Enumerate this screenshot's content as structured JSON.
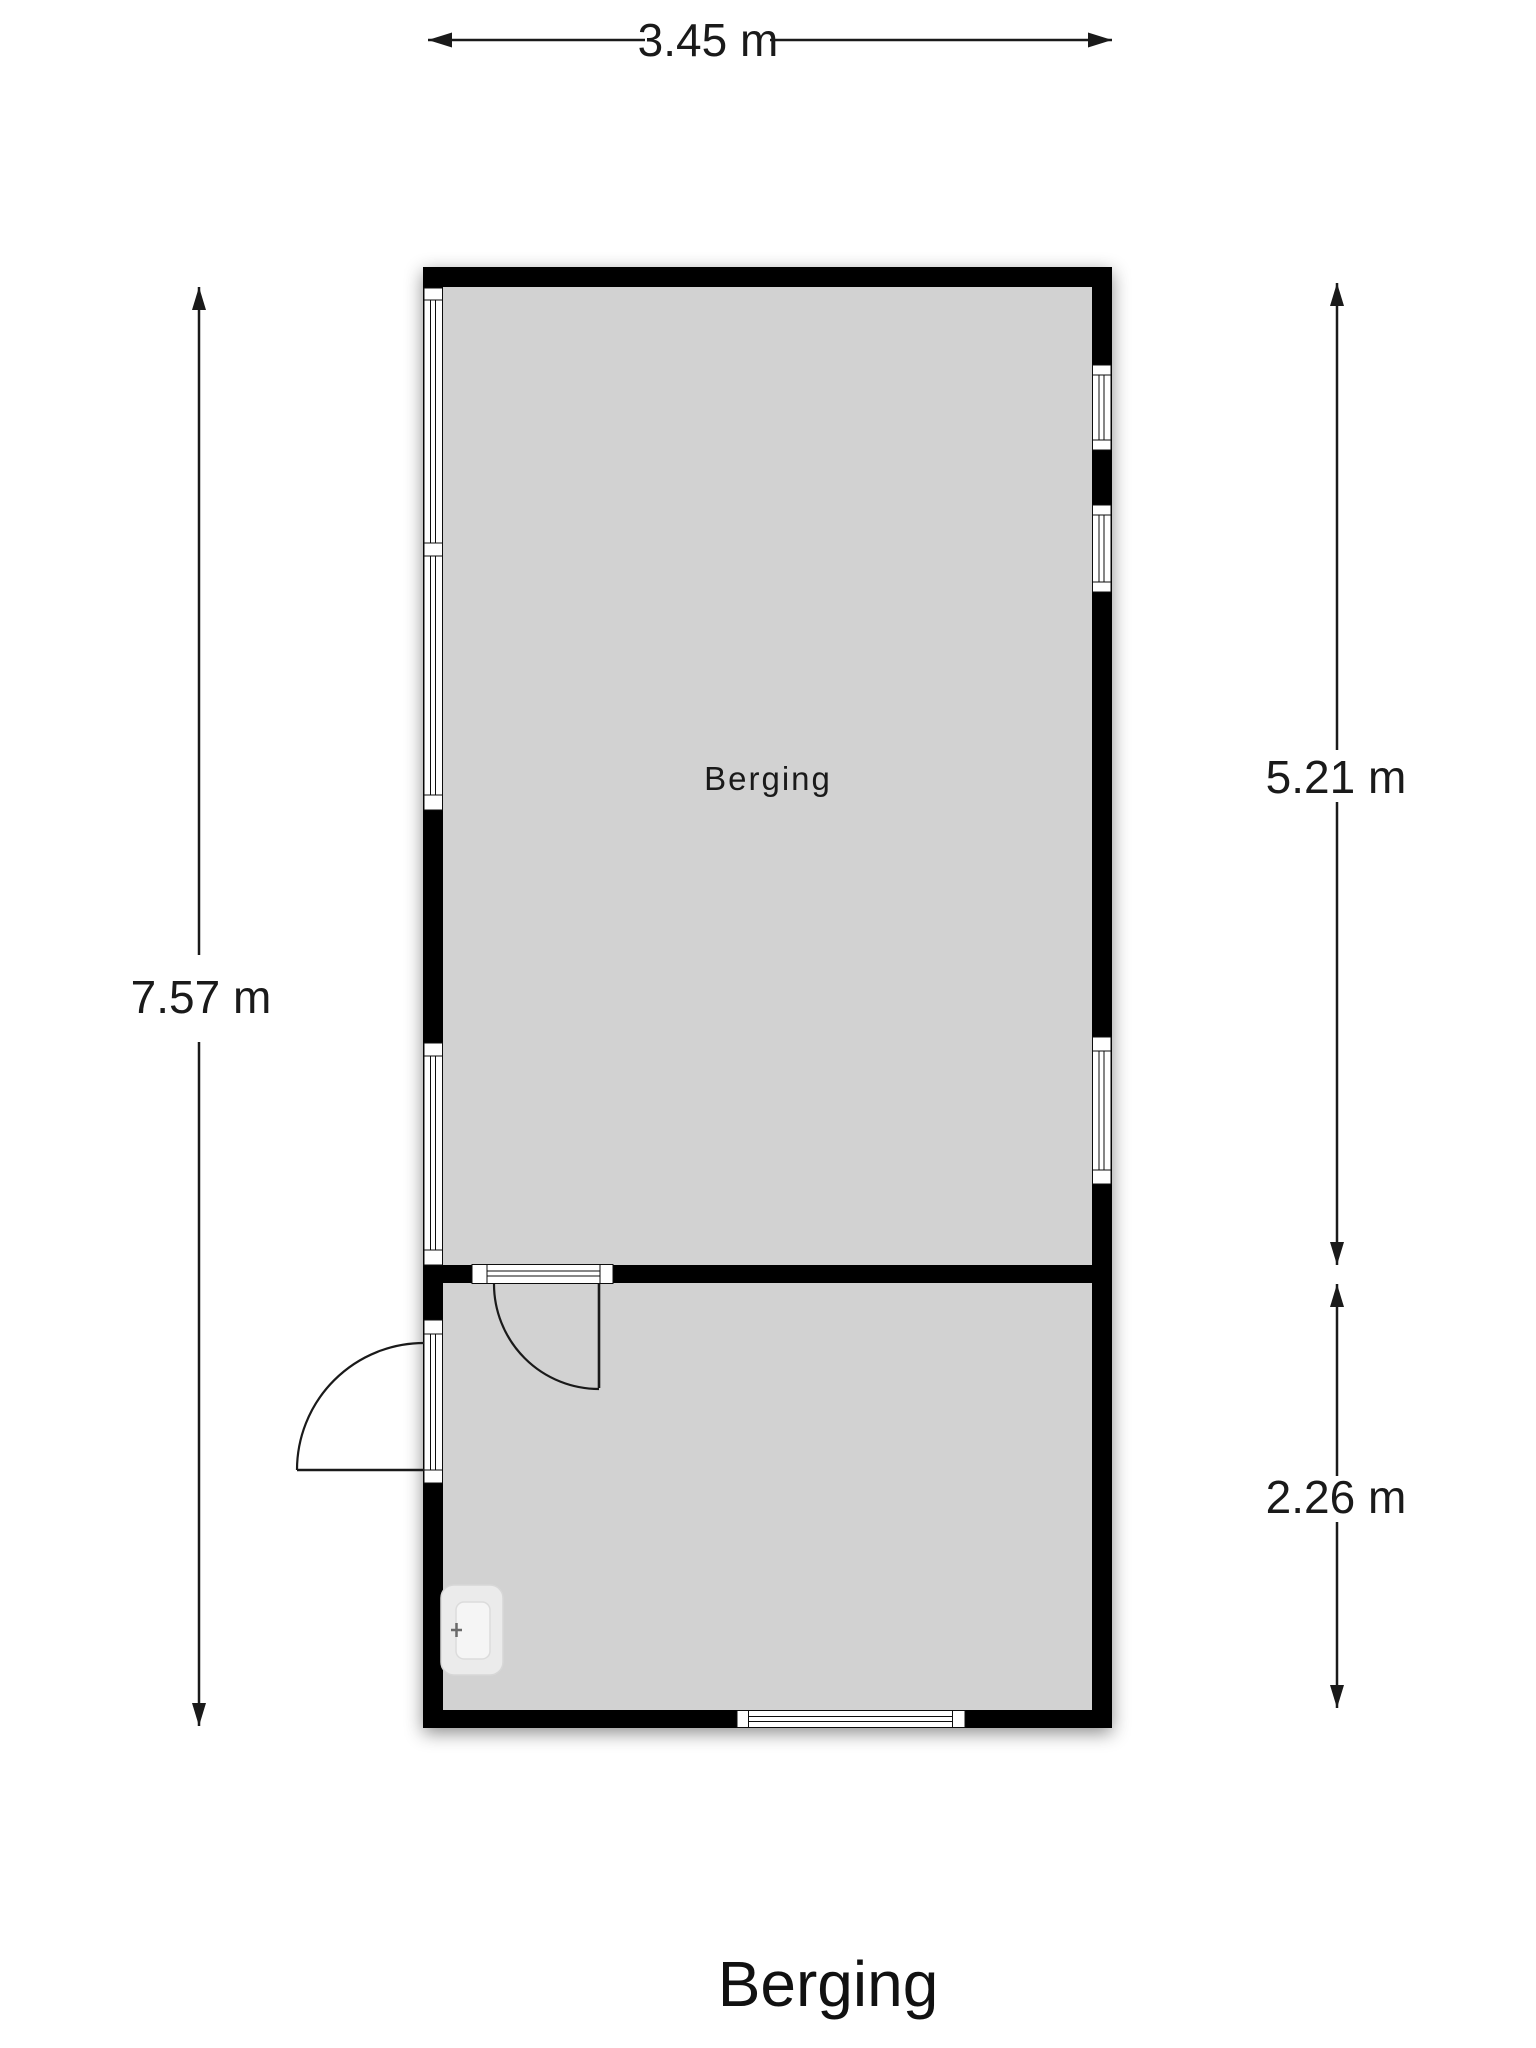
{
  "title": "Berging",
  "room": {
    "label": "Berging"
  },
  "dimensions": {
    "top": {
      "label": "3.45 m"
    },
    "left": {
      "label": "7.57 m"
    },
    "right_upper": {
      "label": "5.21 m"
    },
    "right_lower": {
      "label": "2.26 m"
    }
  },
  "icons": {
    "washbasin": "washbasin-icon",
    "door_swing": "door-swing-arc"
  },
  "colors": {
    "background": "#ffffff",
    "wall": "#050505",
    "floor": "#d2d2d2",
    "window_fill": "#ffffff",
    "fixture": "#ebebeb",
    "dimension_line": "#1a1a1a"
  }
}
